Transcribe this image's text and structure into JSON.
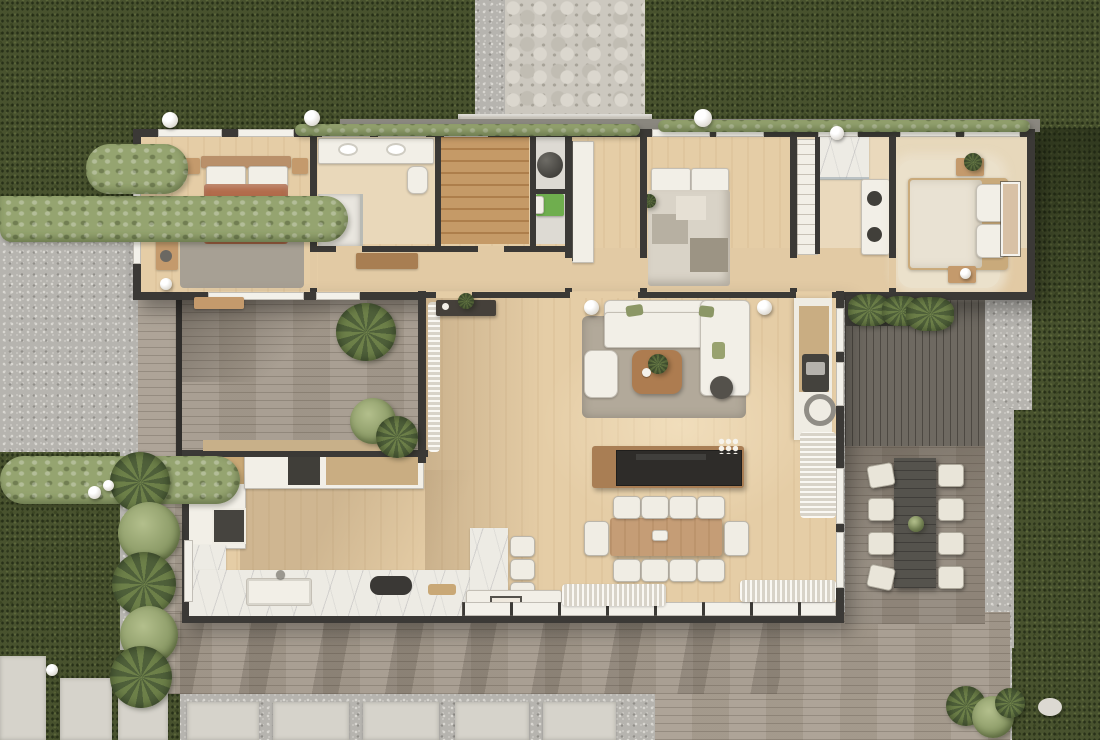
{
  "meta": {
    "title": "Top-down 3D floor plan render of a modern single-storey house",
    "style": "photorealistic architectural visualization, orthographic top view",
    "visible_text": "none"
  },
  "palette": {
    "lawn": "#48522e",
    "hedge": "#95a470",
    "gravel": "#b6b4af",
    "stone_path": "#ccc8bf",
    "deck_wood": "#a59b8e",
    "deck_dark": "#6e6961",
    "walls": "#3b3936",
    "interior_floor": "#e5cda6",
    "marble": "#edebe4",
    "white_furniture": "#f2efe7",
    "terracotta_duvet": "#b26c4b",
    "island_counter": "#2e2c29",
    "wood_furniture": "#c59d76",
    "washer_green": "#6fae4e"
  },
  "scene": {
    "rooms": [
      {
        "name": "master-bedroom",
        "furniture": [
          "double bed with terracotta duvet and white pillows",
          "two wood nightstands",
          "writing desk with stool",
          "grey area rug",
          "windows on west wall"
        ]
      },
      {
        "name": "master-bathroom",
        "furniture": [
          "white double vanity with two sinks",
          "toilet",
          "walk-in shower with glass screen"
        ]
      },
      {
        "name": "walk-in-closet",
        "furniture": [
          "L-shaped timber shelving"
        ]
      },
      {
        "name": "laundry-nook",
        "furniture": [
          "dark sphere pendant / appliance",
          "green laundry unit"
        ]
      },
      {
        "name": "study-pantry",
        "furniture": [
          "built-in white counter along wall"
        ]
      },
      {
        "name": "bedroom-2",
        "furniture": [
          "double bed with grey patchwork quilt",
          "potted plant",
          "north windows"
        ]
      },
      {
        "name": "bathroom-2",
        "furniture": [
          "linen shelf column",
          "walk-in marble shower",
          "vanity with two dark basins"
        ]
      },
      {
        "name": "bedroom-3",
        "furniture": [
          "double bed with cream bedding",
          "cream shag rug",
          "two nightstands with plant and lamp",
          "framed wall art"
        ]
      },
      {
        "name": "hallway",
        "furniture": [
          "timber console table",
          "entry sideboard with plant"
        ]
      },
      {
        "name": "living-room",
        "furniture": [
          "white L-shaped sectional sofa with olive cushions",
          "white armchair",
          "round timber coffee table with plant",
          "dark round side stool",
          "grey area rug",
          "wood-burning stove with flue ring"
        ]
      },
      {
        "name": "kitchen",
        "furniture": [
          "L-shaped marble counter",
          "double sink with faucet",
          "dark cooktop",
          "tall white cabinets with dark-framed doors",
          "marble breakfast bar",
          "three white bar stools"
        ]
      },
      {
        "name": "dining-area",
        "furniture": [
          "timber dining table",
          "ten white shell chairs",
          "island with black countertop and flowers"
        ]
      }
    ],
    "outdoor": [
      {
        "name": "courtyard-deck",
        "items": [
          "dark timber frame",
          "potted monstera",
          "two potted plants",
          "timber bench"
        ]
      },
      {
        "name": "wraparound-deck",
        "items": [
          "weathered grey boards",
          "tree shadows"
        ]
      },
      {
        "name": "outdoor-dining",
        "items": [
          "grey plank table",
          "eight white cushioned chairs",
          "plant centrepiece"
        ]
      },
      {
        "name": "entry-boardwalk",
        "items": [
          "dark vertical boards",
          "green planter boxes",
          "blue-grey gravel pocket"
        ]
      },
      {
        "name": "stone-entry-path",
        "items": [
          "crazy-paving stone walkway",
          "concrete step"
        ]
      },
      {
        "name": "lawn",
        "items": [
          "top-left lawn",
          "top-right lawn",
          "right lawn strip",
          "bottom-left lawn"
        ]
      },
      {
        "name": "gravel-yard",
        "items": [
          "left gravel court",
          "right gravel drainage strips"
        ]
      },
      {
        "name": "paver-walkways",
        "items": [
          "five square concrete pavers along bottom",
          "three vertical slabs bottom-left",
          "white pebble accent"
        ]
      },
      {
        "name": "planting",
        "items": [
          "sage hedge rows",
          "tropical agave bed",
          "shrubs along north facade",
          "white sphere garden lights"
        ]
      }
    ],
    "counts": {
      "bedrooms": 3,
      "bathrooms": 2,
      "indoor_dining_chairs": 10,
      "outdoor_dining_chairs": 8,
      "bar_stools": 3,
      "garden_lights": 10
    }
  }
}
